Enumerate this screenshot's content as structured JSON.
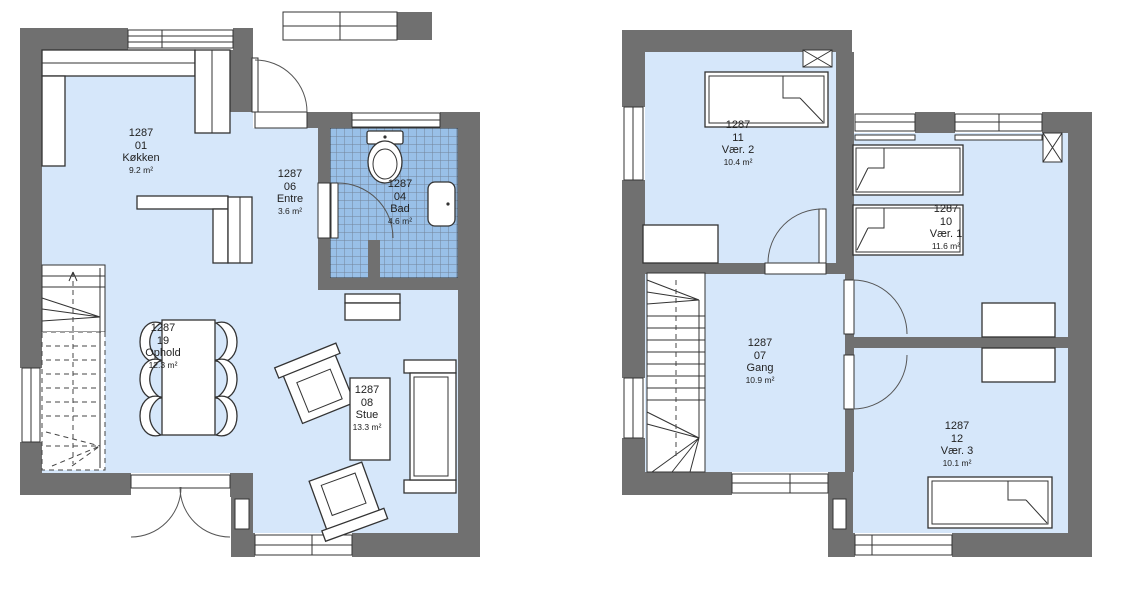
{
  "plan": {
    "floors": [
      {
        "rooms": [
          {
            "project": "1287",
            "id": "01",
            "name": "Køkken",
            "area": "9.2 m²"
          },
          {
            "project": "1287",
            "id": "06",
            "name": "Entre",
            "area": "3.6 m²"
          },
          {
            "project": "1287",
            "id": "04",
            "name": "Bad",
            "area": "4.6 m²"
          },
          {
            "project": "1287",
            "id": "19",
            "name": "Ophold",
            "area": "12.3 m²"
          },
          {
            "project": "1287",
            "id": "08",
            "name": "Stue",
            "area": "13.3 m²"
          }
        ]
      },
      {
        "rooms": [
          {
            "project": "1287",
            "id": "11",
            "name": "Vær. 2",
            "area": "10.4 m²"
          },
          {
            "project": "1287",
            "id": "10",
            "name": "Vær. 1",
            "area": "11.6 m²"
          },
          {
            "project": "1287",
            "id": "07",
            "name": "Gang",
            "area": "10.9 m²"
          },
          {
            "project": "1287",
            "id": "12",
            "name": "Vær. 3",
            "area": "10.1 m²"
          }
        ]
      }
    ]
  },
  "colors": {
    "wall": "#707070",
    "floor": "#d6e7fa",
    "bath_tile": "#99c0e8",
    "tile_grid": "#73849a",
    "outline": "#333333"
  }
}
